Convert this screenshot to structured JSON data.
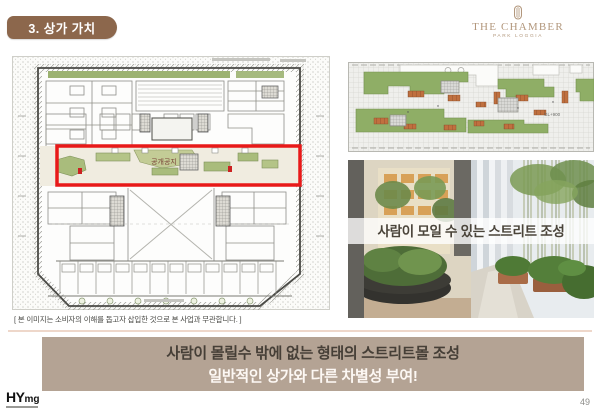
{
  "badge": {
    "label": "3. 상가 가치"
  },
  "logo": {
    "title": "THE CHAMBER",
    "subtitle": "PARK LOGGIA"
  },
  "floor_plan": {
    "highlight_label": "공개공지",
    "caption": "[ 본 이미지는 소비자의 이해를 돕고자 삽입한 것으로 본 사업과 무관합니다. ]"
  },
  "landscape_plan": {
    "level_label": "GL+900"
  },
  "street_photo": {
    "overlay_text": "사람이 모일 수 있는 스트리트 조성"
  },
  "banner": {
    "line1": "사람이 몰릴수 밖에 없는 형태의 스트리트몰 조성",
    "line2": "일반적인 상가와 다른 차별성 부여!"
  },
  "footer": {
    "logo_main": "HY",
    "logo_sub": "mg",
    "page_number": "49"
  },
  "colors": {
    "badge_bg": "#8c674c",
    "logo_bronze": "#b2977c",
    "banner_bg": "#b4a394",
    "banner_text_dark": "#463f37",
    "banner_text_light": "#fdf8f4",
    "highlight_red": "#e81919",
    "plan_green": "#9cb271",
    "landscape_green": "#8fae66",
    "bench_orange": "#c0703f"
  }
}
